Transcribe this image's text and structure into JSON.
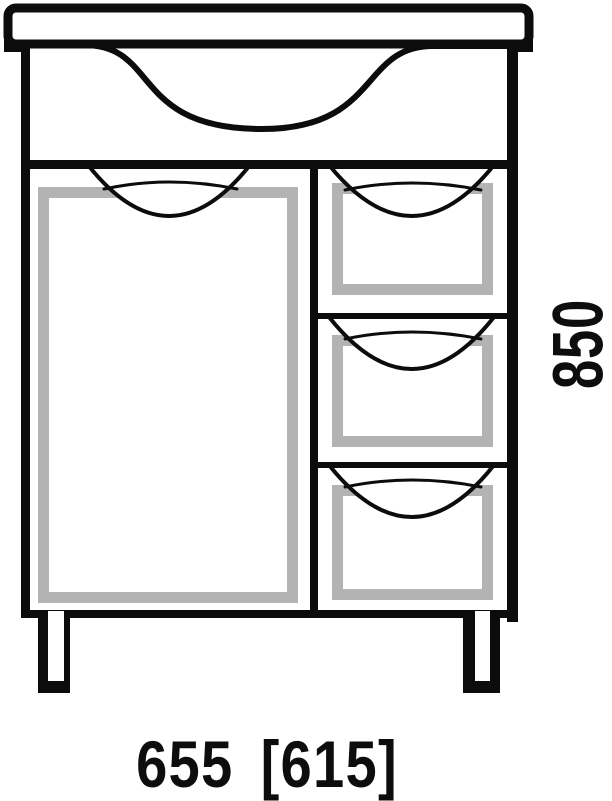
{
  "drawing": {
    "subject": "vanity-cabinet-front-view",
    "dimension_labels": {
      "height": "850",
      "width": "655 [615]"
    },
    "colors": {
      "line": "#0c0c0c",
      "frame_gray": "#b3b3b3",
      "background": "#ffffff"
    }
  }
}
